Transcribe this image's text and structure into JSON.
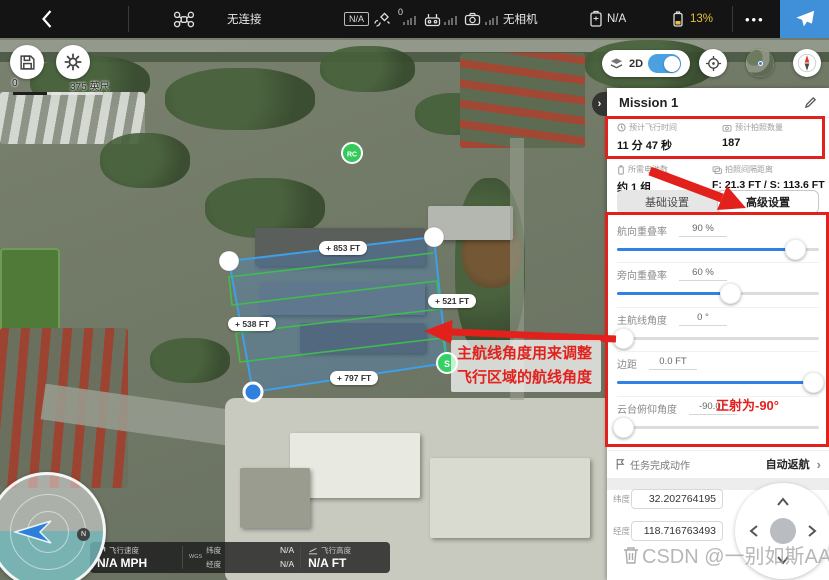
{
  "colors": {
    "takeoff_blue": "#3f90d8",
    "battery_yellow": "#e5c03c",
    "accent_red": "#e2211c",
    "slider_blue": "#2e82e6",
    "polygon_blue": "#3da0e8",
    "route_green": "#3fbf4e"
  },
  "topbar": {
    "aircraft_status": "无连接",
    "flight_mode_badge": "N/A",
    "gps_count": "0",
    "camera_status": "无相机",
    "aircraft_battery": "N/A",
    "rc_battery": "13%",
    "more_icon": "•••"
  },
  "map_controls": {
    "mode_label": "2D",
    "scale_zero": "0",
    "scale_distance": "375 英尺"
  },
  "map": {
    "waypoints": [
      "+ 853 FT",
      "+ 521 FT",
      "+ 538 FT",
      "+ 797 FT"
    ],
    "rc_marker": "RC",
    "start_marker": "S"
  },
  "panel": {
    "title": "Mission 1",
    "stats": [
      {
        "label": "预计飞行时间",
        "value": "11 分 47 秒"
      },
      {
        "label": "预计拍照数量",
        "value": "187"
      },
      {
        "label": "所需电池数",
        "value": "约 1 组"
      },
      {
        "label": "拍照间隔距离",
        "value": "F: 21.3 FT / S: 113.6 FT"
      }
    ],
    "tabs": {
      "basic": "基础设置",
      "advanced": "高级设置"
    },
    "sliders": [
      {
        "label": "航向重叠率",
        "value": "90 %",
        "percent": 88
      },
      {
        "label": "旁向重叠率",
        "value": "60 %",
        "percent": 56
      },
      {
        "label": "主航线角度",
        "value": "0 °",
        "percent": 3
      },
      {
        "label": "边距",
        "value": "0.0 FT",
        "percent": 97
      },
      {
        "label": "云台俯仰角度",
        "value": "-90.0 °",
        "percent": 3
      }
    ],
    "finish": {
      "label": "任务完成动作",
      "value": "自动返航"
    },
    "coords": {
      "lat_label": "纬度",
      "lat_value": "32.202764195",
      "lng_label": "经度",
      "lng_value": "118.716763493"
    }
  },
  "annotations": {
    "route_note_line1": "主航线角度用来调整",
    "route_note_line2": "飞行区域的航线角度",
    "gimbal_note": "正射为-90°"
  },
  "telemetry": {
    "speed_label": "飞行速度",
    "speed_value": "N/A MPH",
    "datum": "WGS",
    "lat_label": "纬度",
    "lat_value": "N/A",
    "lng_label": "经度",
    "lng_value": "N/A",
    "alt_label": "飞行高度",
    "alt_value": "N/A FT"
  },
  "compass": {
    "north": "N"
  },
  "watermark": "CSDN @一别如斯AA"
}
